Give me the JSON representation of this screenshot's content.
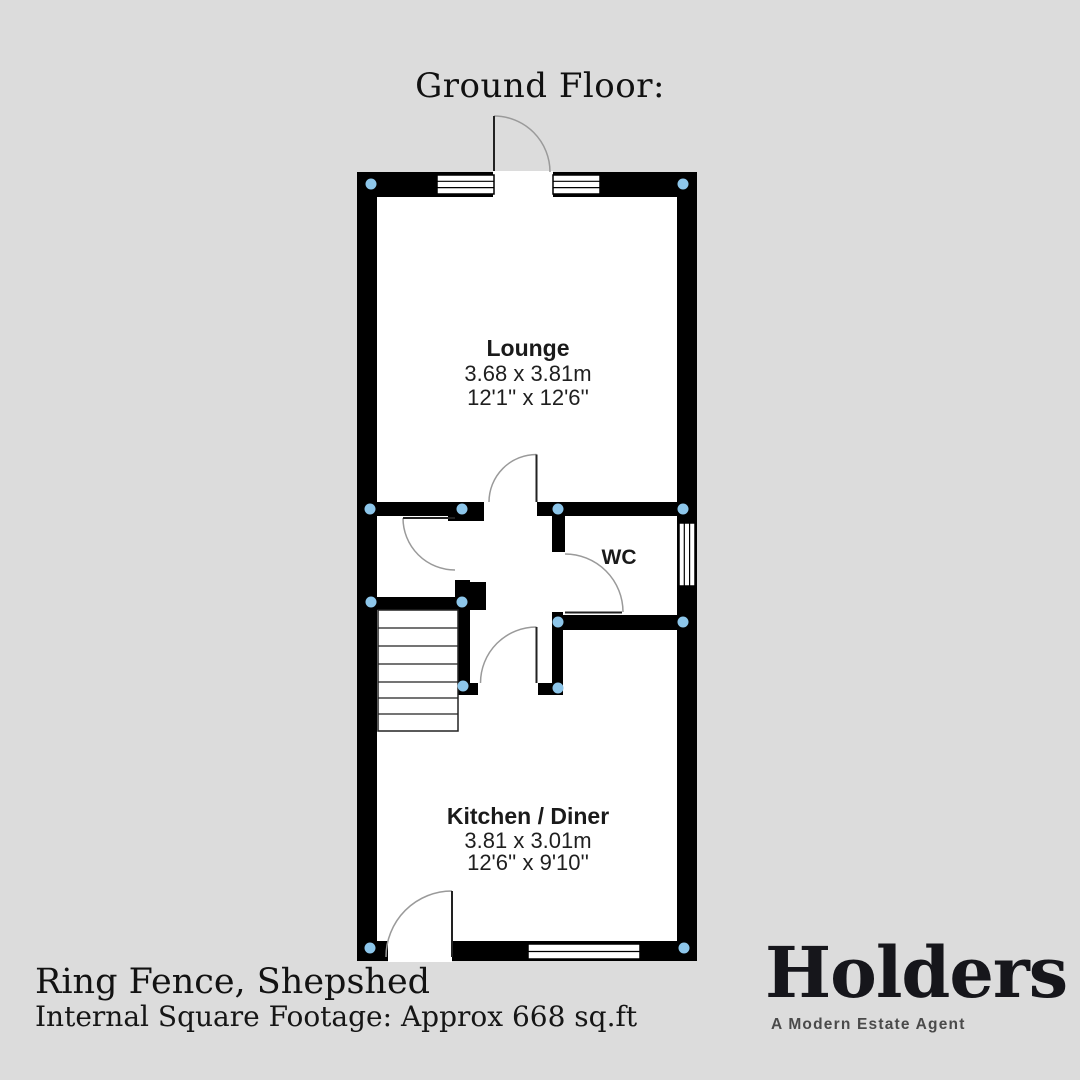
{
  "title": "Ground Floor:",
  "floorplan": {
    "rooms": [
      {
        "name": "Lounge",
        "metric": "3.68 x 3.81m",
        "imperial": "12'1'' x 12'6''"
      },
      {
        "name": "WC"
      },
      {
        "name": "Kitchen / Diner",
        "metric": "3.81 x 3.01m",
        "imperial": "12'6'' x 9'10''"
      }
    ]
  },
  "footer": {
    "address": "Ring Fence, Shepshed",
    "square_footage": "Internal Square Footage: Approx 668 sq.ft"
  },
  "brand": {
    "name": "Holders",
    "tagline": "A Modern Estate Agent"
  },
  "colors": {
    "background": "#dcdcdc",
    "wall": "#000000",
    "room_fill": "#ffffff",
    "junction_dot": "#8dc6ea",
    "door_arc": "#9a9a9a"
  }
}
